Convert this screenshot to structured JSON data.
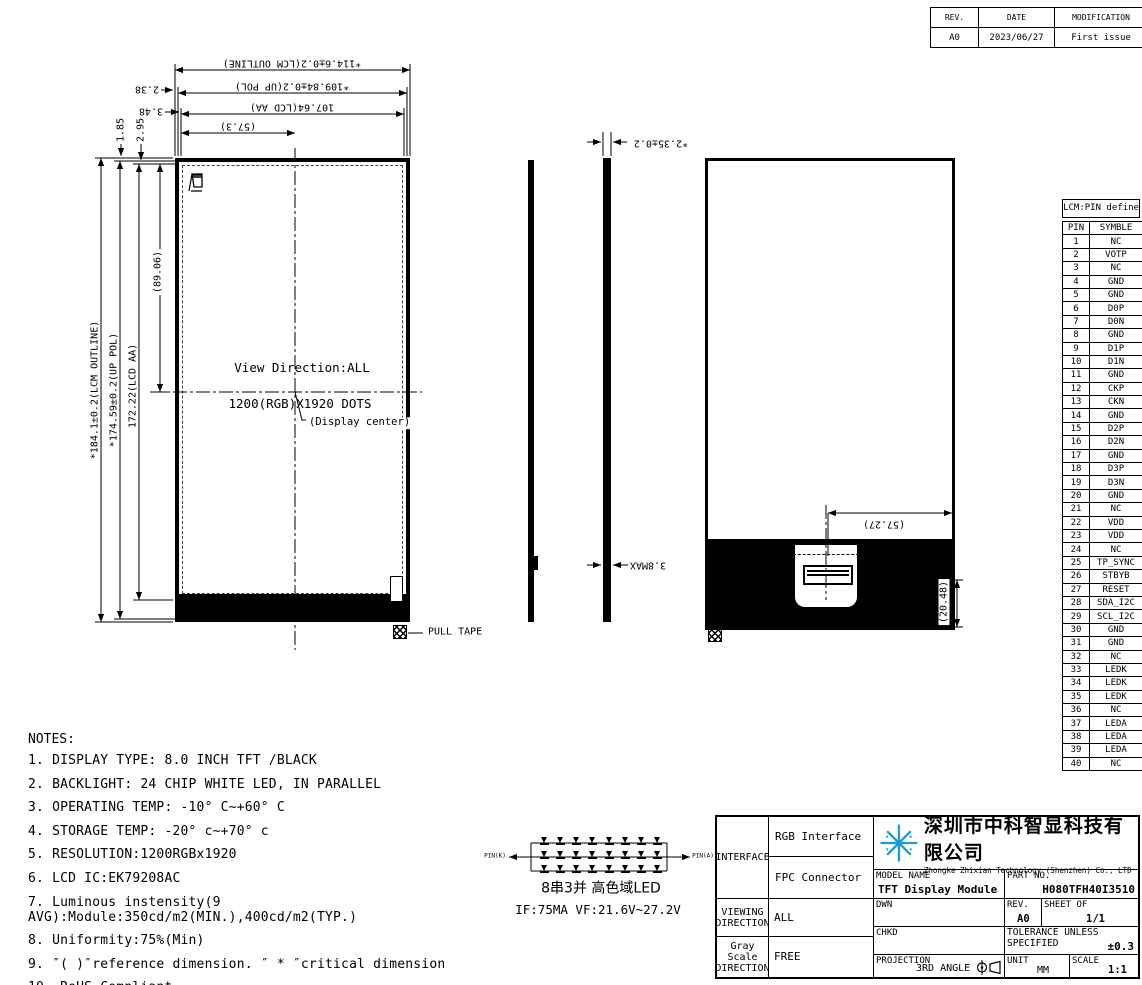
{
  "sheet": {
    "bg": "#ffffff",
    "line_color": "#000000",
    "logo_blue": "#1d9bd7"
  },
  "revision_table": {
    "headers": [
      "REV.",
      "DATE",
      "MODIFICATION"
    ],
    "rows": [
      [
        "A0",
        "2023/06/27",
        "First issue"
      ]
    ]
  },
  "dims": {
    "h_outline": "*114.6±0.2(LCM OUTLINE)",
    "h_pol": "*109.84±0.2(UP POL)",
    "h_aa": "107.64(LCD AA)",
    "h_half": "(57.3)",
    "h_edge1": "2.38",
    "h_edge2": "3.48",
    "v_outline": "*184.1±0.2(LCM OUTLINE)",
    "v_pol": "*174.59±0.2(UP POL)",
    "v_aa": "172.22(LCD AA)",
    "v_half": "(89.06)",
    "v_edge1": "1.85",
    "v_edge2": "2.95",
    "thickness": "*2.35±0.2",
    "thickness_max": "3.8MAX",
    "back_width_half": "(57.27)",
    "back_fpc_height": "(20.48)"
  },
  "front_view": {
    "view_direction": "View Direction:ALL",
    "resolution": "1200(RGB)X1920 DOTS",
    "display_center": "(Display center)",
    "pull_tape": "PULL TAPE"
  },
  "pin_table": {
    "title": "LCM:PIN define",
    "headers": [
      "PIN",
      "SYMBLE"
    ],
    "rows": [
      [
        "1",
        "NC"
      ],
      [
        "2",
        "VOTP"
      ],
      [
        "3",
        "NC"
      ],
      [
        "4",
        "GND"
      ],
      [
        "5",
        "GND"
      ],
      [
        "6",
        "D0P"
      ],
      [
        "7",
        "D0N"
      ],
      [
        "8",
        "GND"
      ],
      [
        "9",
        "D1P"
      ],
      [
        "10",
        "D1N"
      ],
      [
        "11",
        "GND"
      ],
      [
        "12",
        "CKP"
      ],
      [
        "13",
        "CKN"
      ],
      [
        "14",
        "GND"
      ],
      [
        "15",
        "D2P"
      ],
      [
        "16",
        "D2N"
      ],
      [
        "17",
        "GND"
      ],
      [
        "18",
        "D3P"
      ],
      [
        "19",
        "D3N"
      ],
      [
        "20",
        "GND"
      ],
      [
        "21",
        "NC"
      ],
      [
        "22",
        "VDD"
      ],
      [
        "23",
        "VDD"
      ],
      [
        "24",
        "NC"
      ],
      [
        "25",
        "TP_SYNC"
      ],
      [
        "26",
        "STBYB"
      ],
      [
        "27",
        "RESET"
      ],
      [
        "28",
        "SDA_I2C"
      ],
      [
        "29",
        "SCL_I2C"
      ],
      [
        "30",
        "GND"
      ],
      [
        "31",
        "GND"
      ],
      [
        "32",
        "NC"
      ],
      [
        "33",
        "LEDK"
      ],
      [
        "34",
        "LEDK"
      ],
      [
        "35",
        "LEDK"
      ],
      [
        "36",
        "NC"
      ],
      [
        "37",
        "LEDA"
      ],
      [
        "38",
        "LEDA"
      ],
      [
        "39",
        "LEDA"
      ],
      [
        "40",
        "NC"
      ]
    ]
  },
  "notes": {
    "title": "NOTES:",
    "items": [
      "DISPLAY TYPE: 8.0 INCH TFT /BLACK",
      "BACKLIGHT: 24 CHIP WHITE LED, IN PARALLEL",
      "OPERATING TEMP: -10° C~+60° C",
      "STORAGE TEMP: -20° c~+70° c",
      "RESOLUTION:1200RGBx1920",
      "LCD IC:EK79208AC",
      "Luminous instensity(9 AVG):Module:350cd/m2(MIN.),400cd/m2(TYP.)",
      "Uniformity:75%(Min)",
      "″( )″reference dimension. ″ * ″critical dimension",
      "RoHS Compliant"
    ]
  },
  "led_circuit": {
    "pin_left": "PIN(K)",
    "pin_right": "PIN(A)",
    "rows": 3,
    "cols": 8,
    "caption1": "8串3并 高色域LED",
    "caption2": "IF:75MA  VF:21.6V~27.2V"
  },
  "title_block": {
    "interface_label": "INTERFACE",
    "interface_row1": "RGB Interface",
    "interface_row2": "FPC Connector",
    "viewing_label": "VIEWING DIRECTION",
    "viewing_value": "ALL",
    "gray_label": "Gray Scale DIRECTION",
    "gray_value": "FREE",
    "company_cn": "深圳市中科智显科技有限公司",
    "company_en": "Zhongke Zhixian Technology (Shenzhen) Co., LTD",
    "model_name_label": "MODEL NAME",
    "model_name": "TFT Display Module",
    "part_no_label": "PART NO.",
    "part_no": "H080TFH40I3510",
    "dwn_label": "DWN",
    "chkd_label": "CHKD",
    "rev_label": "REV.",
    "rev_value": "A0",
    "sheet_label": "SHEET OF",
    "sheet_value": "1/1",
    "tolerance_label": "TOLERANCE UNLESS SPECIFIED",
    "tolerance_value": "±0.3",
    "projection_label": "PROJECTION",
    "projection_value": "3RD ANGLE",
    "unit_label": "UNIT",
    "unit_value": "MM",
    "scale_label": "SCALE",
    "scale_value": "1:1"
  }
}
